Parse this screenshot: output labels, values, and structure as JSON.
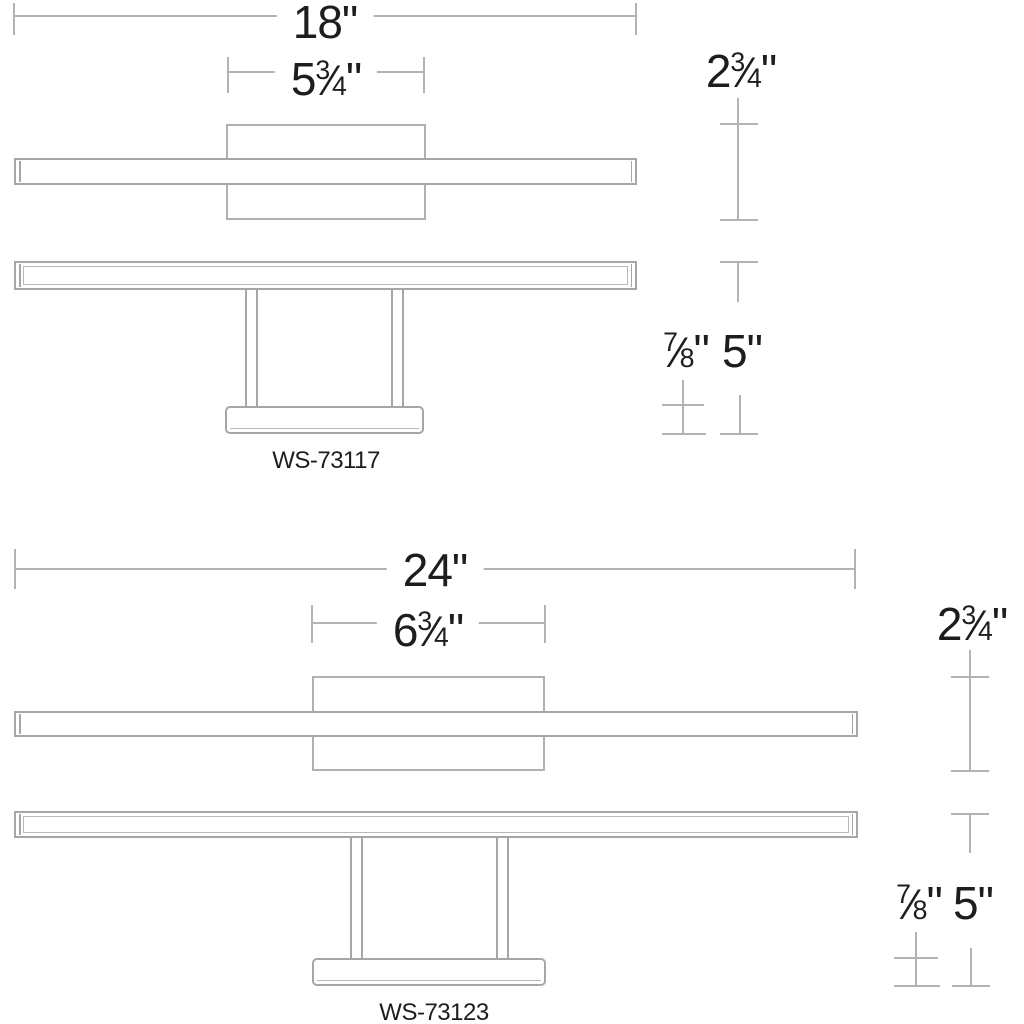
{
  "drawing": {
    "frac_slash": "⁄",
    "fixtures": [
      {
        "model": "WS-73117",
        "overall_width": {
          "value": "18",
          "unit": "\""
        },
        "backplate_width": {
          "whole": "5",
          "num": "3",
          "den": "4",
          "unit": "\""
        },
        "fixture_height": {
          "whole": "2",
          "num": "3",
          "den": "4",
          "unit": "\""
        },
        "base_depth": {
          "whole": "",
          "num": "7",
          "den": "8",
          "unit": "\""
        },
        "extension": {
          "value": "5",
          "unit": "\""
        }
      },
      {
        "model": "WS-73123",
        "overall_width": {
          "value": "24",
          "unit": "\""
        },
        "backplate_width": {
          "whole": "6",
          "num": "3",
          "den": "4",
          "unit": "\""
        },
        "fixture_height": {
          "whole": "2",
          "num": "3",
          "den": "4",
          "unit": "\""
        },
        "base_depth": {
          "whole": "",
          "num": "7",
          "den": "8",
          "unit": "\""
        },
        "extension": {
          "value": "5",
          "unit": "\""
        }
      }
    ],
    "colors": {
      "outline": "#a6a6a6",
      "dim_line": "#b3b3b3",
      "text": "#1d1d1d",
      "background": "#ffffff"
    }
  }
}
